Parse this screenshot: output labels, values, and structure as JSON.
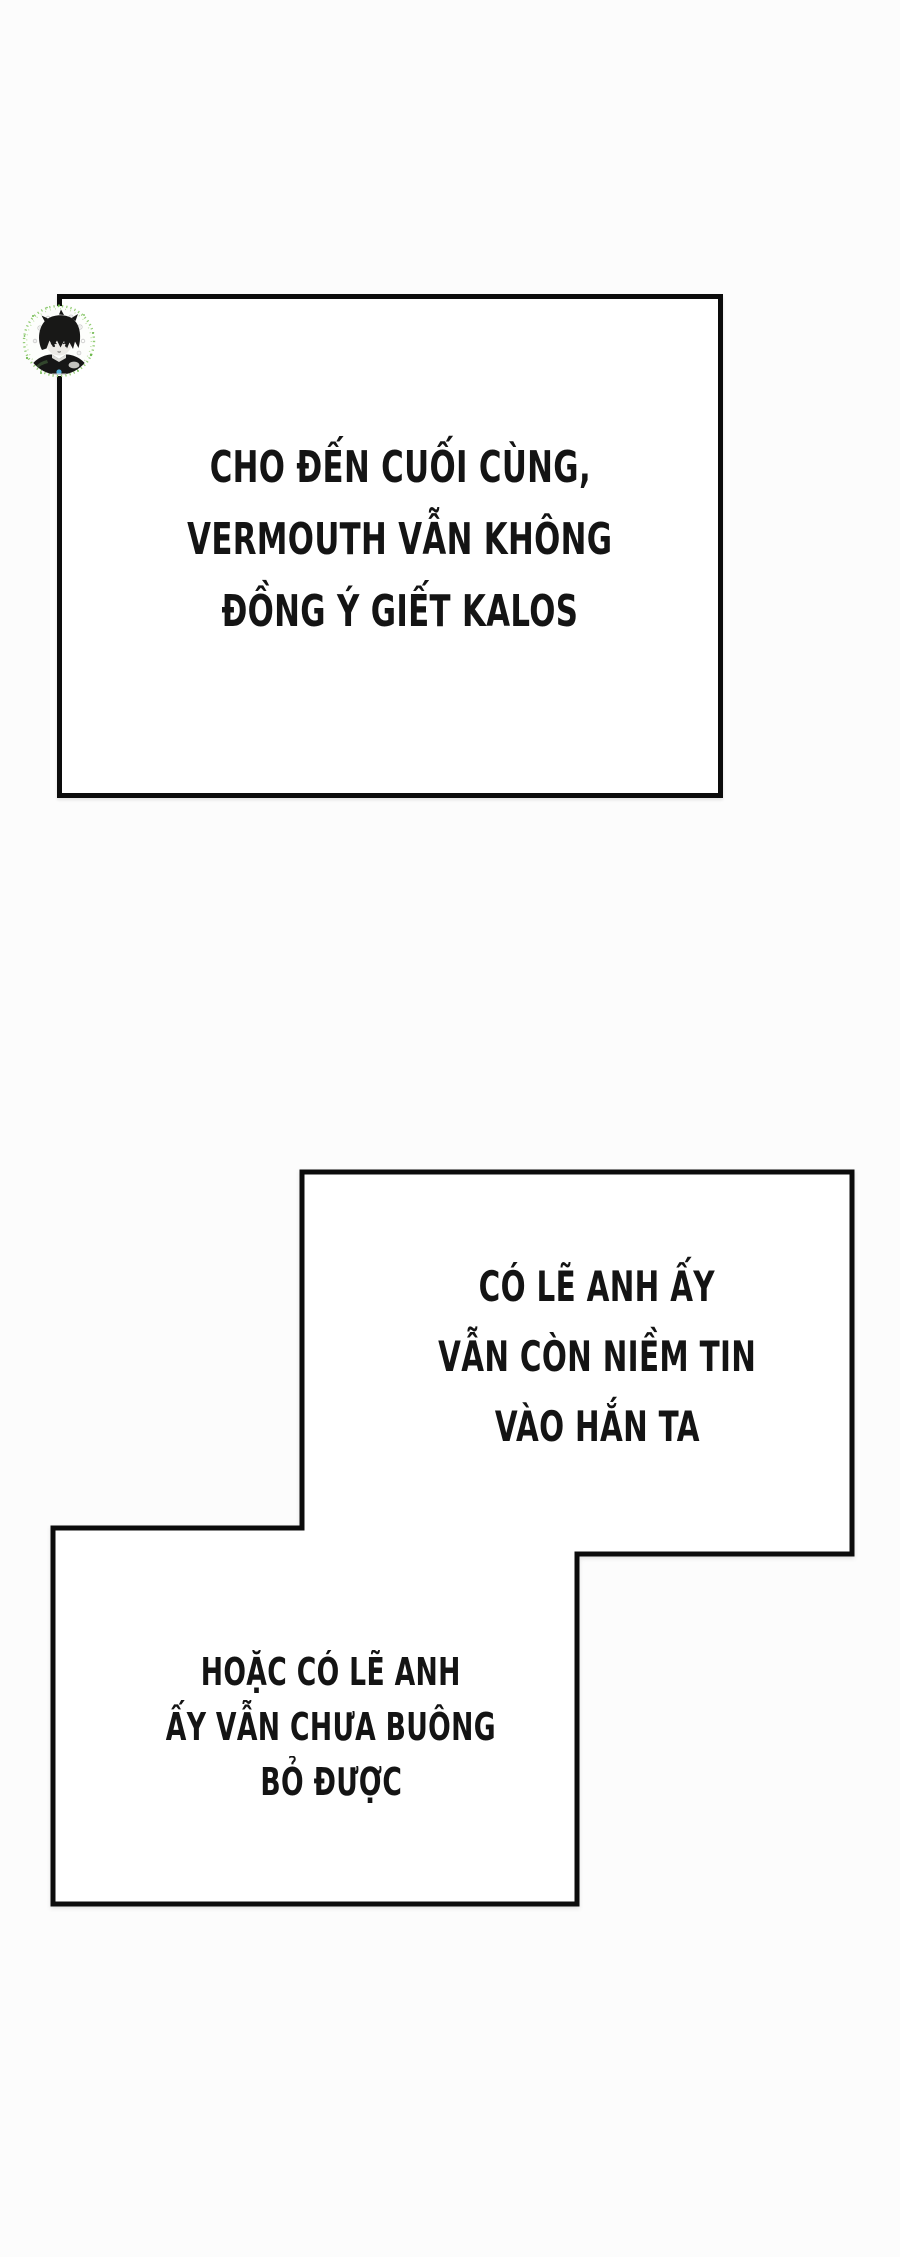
{
  "page": {
    "width_px": 900,
    "height_px": 2257,
    "background_color": "#fcfcfc"
  },
  "colors": {
    "panel_border": "#0c0c0c",
    "panel_background": "#ffffff",
    "caption_text": "#141414",
    "avatar_ring_green": "#8cc96b",
    "avatar_hair_black": "#181817",
    "avatar_accent_blue": "#56b7e6"
  },
  "icons": {
    "avatar": "chibi-boy-avatar-sticker"
  },
  "panels": [
    {
      "name": "caption-box-top",
      "lines": [
        "CHO ĐẾN CUỐI CÙNG,",
        "VERMOUTH VẪN KHÔNG",
        "ĐỒNG Ý GIẾT KALOS"
      ]
    },
    {
      "name": "caption-box-upper-right",
      "lines": [
        "CÓ LẼ ANH ẤY",
        "VẪN CÒN NIỀM TIN",
        "VÀO HẮN TA"
      ]
    },
    {
      "name": "caption-box-lower-left",
      "lines": [
        "HOẶC CÓ LẼ ANH",
        "ẤY VẪN CHƯA BUÔNG",
        "BỎ ĐƯỢC"
      ]
    }
  ]
}
